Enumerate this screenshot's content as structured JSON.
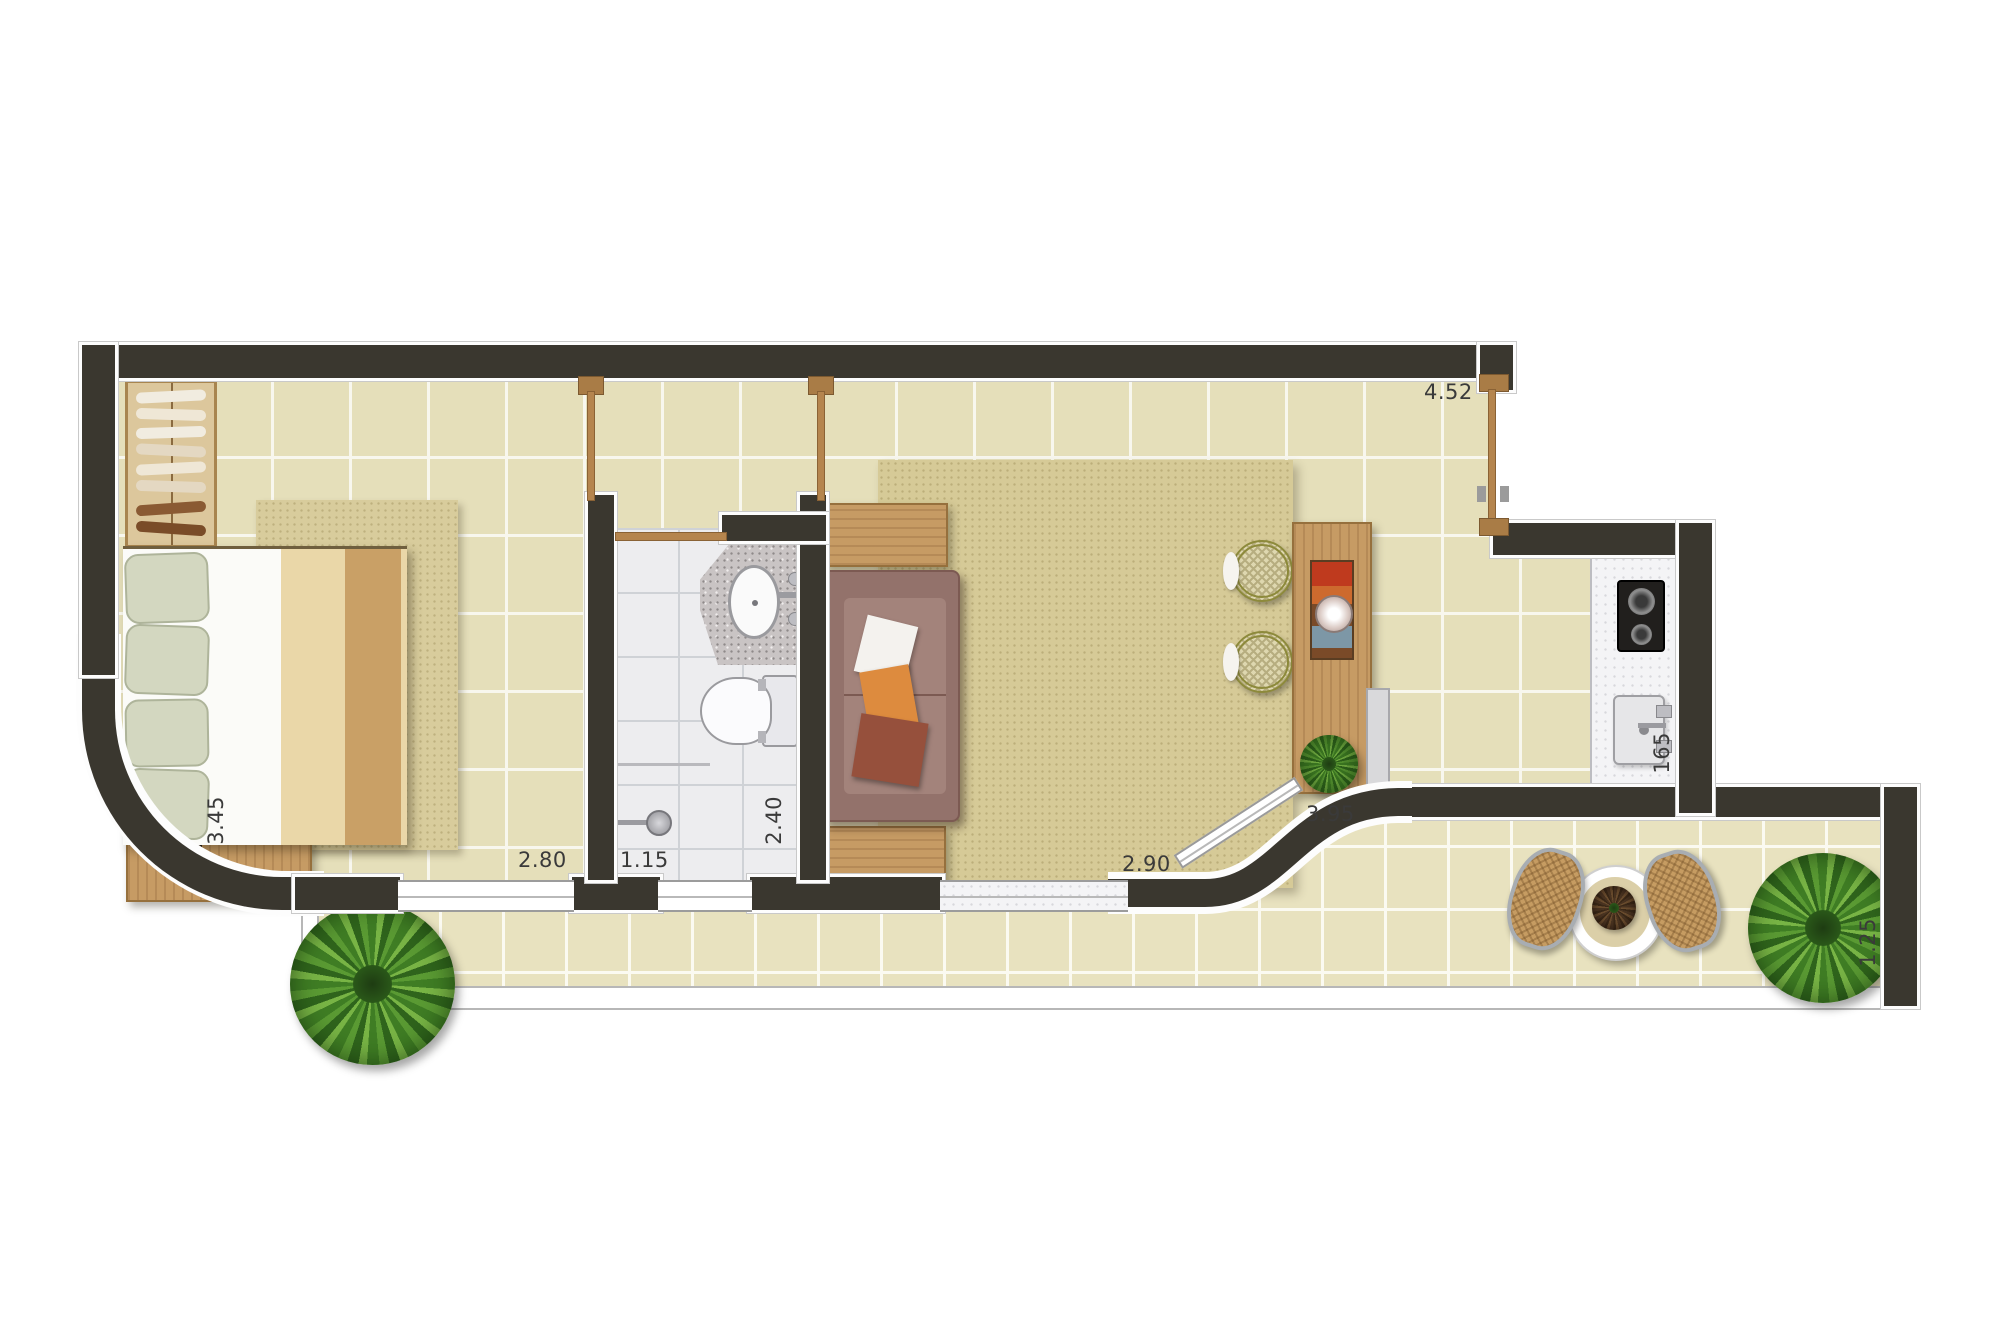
{
  "plan": {
    "type": "apartment-floor-plan",
    "dimensions": {
      "living_right_wall": "4.52",
      "bedroom_side": "3.45",
      "bedroom_window": "2.80",
      "bathroom_window": "1.15",
      "bathroom_depth": "2.40",
      "living_window": "2.90",
      "terrace_curve": "3.95",
      "kitchen_counter": "165",
      "terrace_depth": "1.25"
    },
    "colors": {
      "wall": "#3a372f",
      "floor_tile": "#e5dfba",
      "terrace_tile": "#e8e2bf",
      "bath_tile": "#ededef",
      "wood": "#c69b64",
      "rug": "#d6ca97",
      "sofa": "#93726b",
      "plant_green": "#3f7d24",
      "accent_orange": "#dd8b3e"
    },
    "furniture": [
      "wardrobe",
      "double-bed",
      "bedroom-rug",
      "bathroom-sink",
      "toilet",
      "shower",
      "sofa",
      "side-tables",
      "living-rug",
      "rattan-stools",
      "bar-counter",
      "counter-plant",
      "cooktop",
      "kitchen-sink",
      "terrace-table",
      "terrace-chairs",
      "terrace-plants"
    ]
  }
}
